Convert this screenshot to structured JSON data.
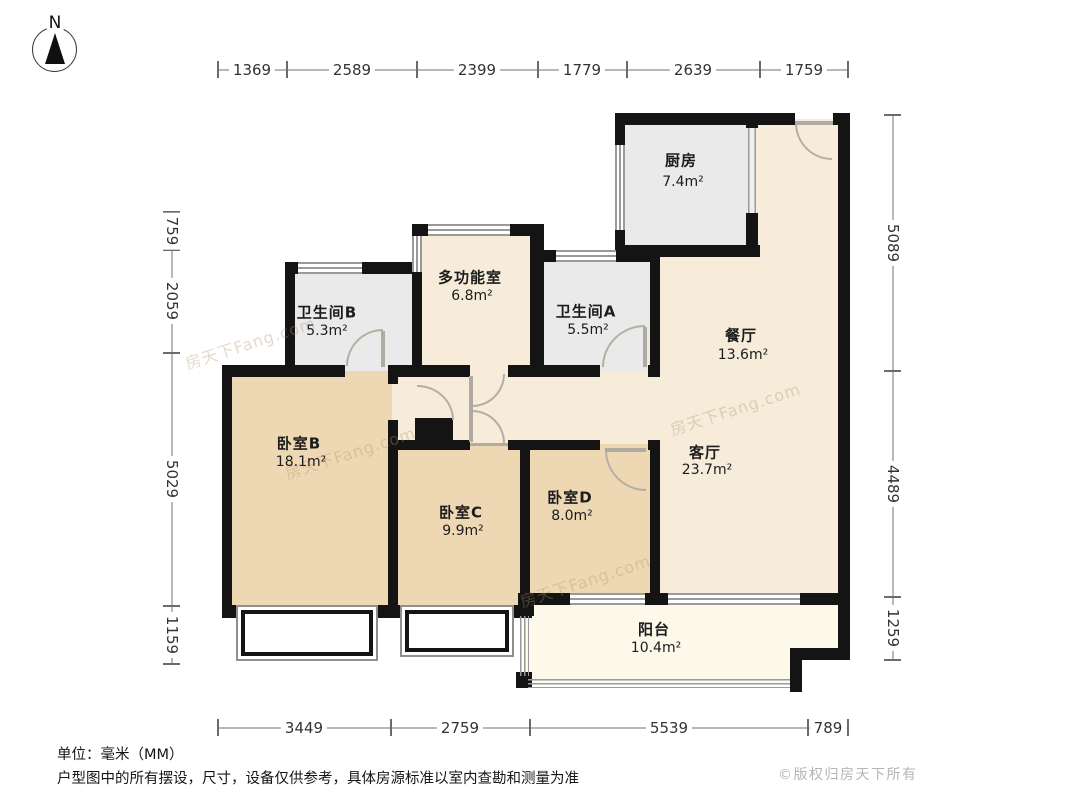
{
  "compass": {
    "label": "N"
  },
  "dimensions": {
    "top": [
      "1369",
      "2589",
      "2399",
      "1779",
      "2639",
      "1759"
    ],
    "bottom": [
      "3449",
      "2759",
      "5539",
      "789"
    ],
    "left": [
      "759",
      "2059",
      "5029",
      "1159"
    ],
    "right": [
      "5089",
      "4489",
      "1259"
    ]
  },
  "rooms": {
    "kitchen": {
      "label": "厨房",
      "area": "7.4m²"
    },
    "multi": {
      "label": "多功能室",
      "area": "6.8m²"
    },
    "bath_b": {
      "label": "卫生间B",
      "area": "5.3m²"
    },
    "bath_a": {
      "label": "卫生间A",
      "area": "5.5m²"
    },
    "dining": {
      "label": "餐厅",
      "area": "13.6m²"
    },
    "living": {
      "label": "客厅",
      "area": "23.7m²"
    },
    "bed_b": {
      "label": "卧室B",
      "area": "18.1m²"
    },
    "bed_c": {
      "label": "卧室C",
      "area": "9.9m²"
    },
    "bed_d": {
      "label": "卧室D",
      "area": "8.0m²"
    },
    "balcony": {
      "label": "阳台",
      "area": "10.4m²"
    }
  },
  "footer": {
    "unit_note": "单位：毫米（MM）",
    "disclaimer": "户型图中的所有摆设，尺寸，设备仅供参考，具体房源标准以室内查勘和测量为准",
    "copyright": "©版权归房天下所有"
  },
  "watermark": {
    "text": "房天下Fang.com"
  },
  "colors": {
    "wall": "#141414",
    "living": "#f6ecd9",
    "bedroom": "#edd8b3",
    "service": "#eaeaea",
    "balcony": "#fcf9ea"
  }
}
